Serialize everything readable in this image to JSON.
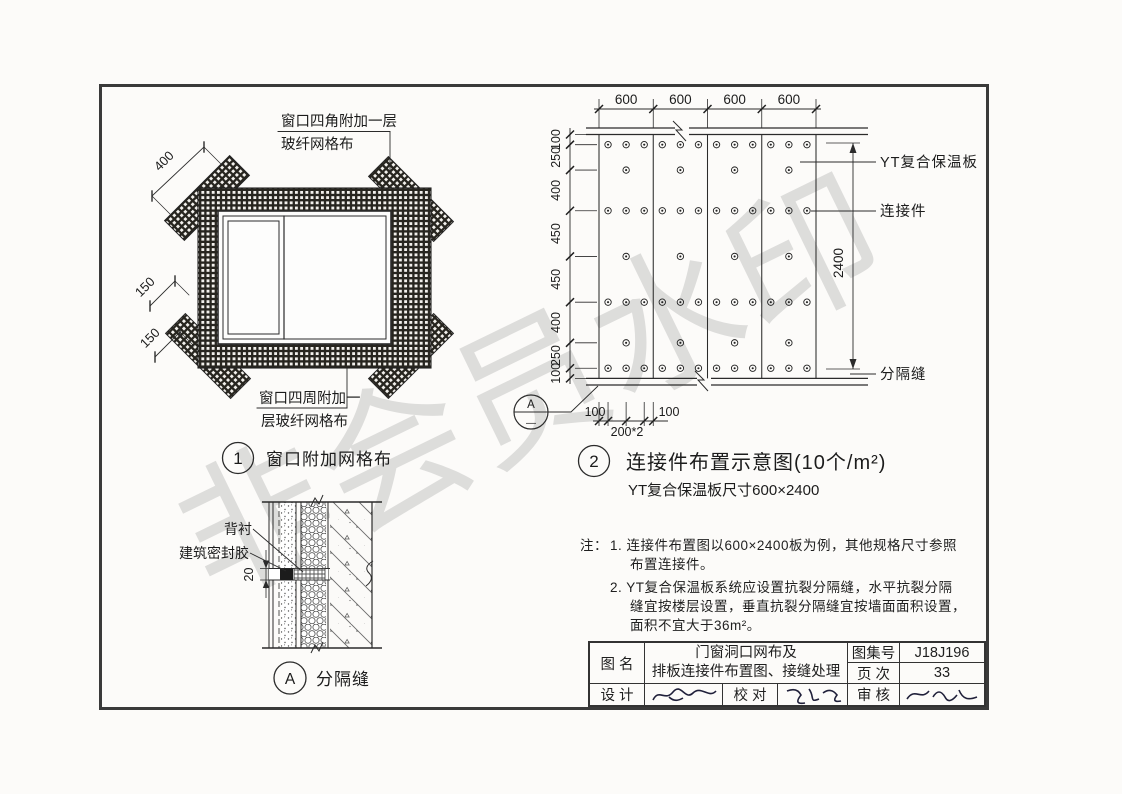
{
  "page": {
    "watermark": "非会员水印"
  },
  "diagram1": {
    "number": "1",
    "title": "窗口附加网格布",
    "label_corner_line1": "窗口四角附加一层",
    "label_corner_line2": "玻纤网格布",
    "label_perimeter_line1": "窗口四周附加一",
    "label_perimeter_line2": "层玻纤网格布",
    "dim_corner_strip": "400",
    "dim_band_a": "150",
    "dim_band_b": "150"
  },
  "diagram2": {
    "number": "2",
    "title": "连接件布置示意图(10个/m²)",
    "subtitle": "YT复合保温板尺寸600×2400",
    "dims_top": [
      "600",
      "600",
      "600",
      "600"
    ],
    "dims_left": [
      "100",
      "250",
      "400",
      "450",
      "450",
      "400",
      "250",
      "100"
    ],
    "dim_right": "2400",
    "dim_bottom_left": "100",
    "dim_bottom_mid": "200*2",
    "dim_bottom_right": "100",
    "label_board": "YT复合保温板",
    "label_connector": "连接件",
    "label_joint": "分隔缝",
    "callout_top": "A",
    "callout_bottom": "—",
    "connector_layout": {
      "type": "scatter",
      "board_count": 4,
      "board_size_mm": [
        600,
        2400
      ],
      "row_offsets_mm": [
        100,
        350,
        750,
        1200,
        1650,
        2050,
        2300
      ],
      "row_patterns": [
        "full",
        "center",
        "full",
        "center",
        "full",
        "center",
        "full"
      ],
      "x_offsets_full_mm": [
        100,
        300,
        500
      ],
      "x_offsets_center_mm": [
        300
      ],
      "density_label": "10个/m²"
    }
  },
  "detailA": {
    "letter": "A",
    "title": "分隔缝",
    "label_backing": "背衬",
    "label_sealant": "建筑密封胶",
    "dim_joint": "20"
  },
  "notes": {
    "prefix": "注：",
    "line1": "1. 连接件布置图以600×2400板为例，其他规格尺寸参照",
    "line2": "布置连接件。",
    "line3": "2. YT复合保温板系统应设置抗裂分隔缝，水平抗裂分隔",
    "line4": "缝宜按楼层设置，垂直抗裂分隔缝宜按墙面面积设置，",
    "line5": "面积不宜大于36m²。"
  },
  "titleblock": {
    "fig_name_label": "图 名",
    "fig_name_line1": "门窗洞口网布及",
    "fig_name_line2": "排板连接件布置图、接缝处理",
    "atlas_label": "图集号",
    "atlas_value": "J18J196",
    "page_label": "页 次",
    "page_value": "33",
    "design_label": "设 计",
    "check_label": "校 对",
    "review_label": "审 核"
  }
}
